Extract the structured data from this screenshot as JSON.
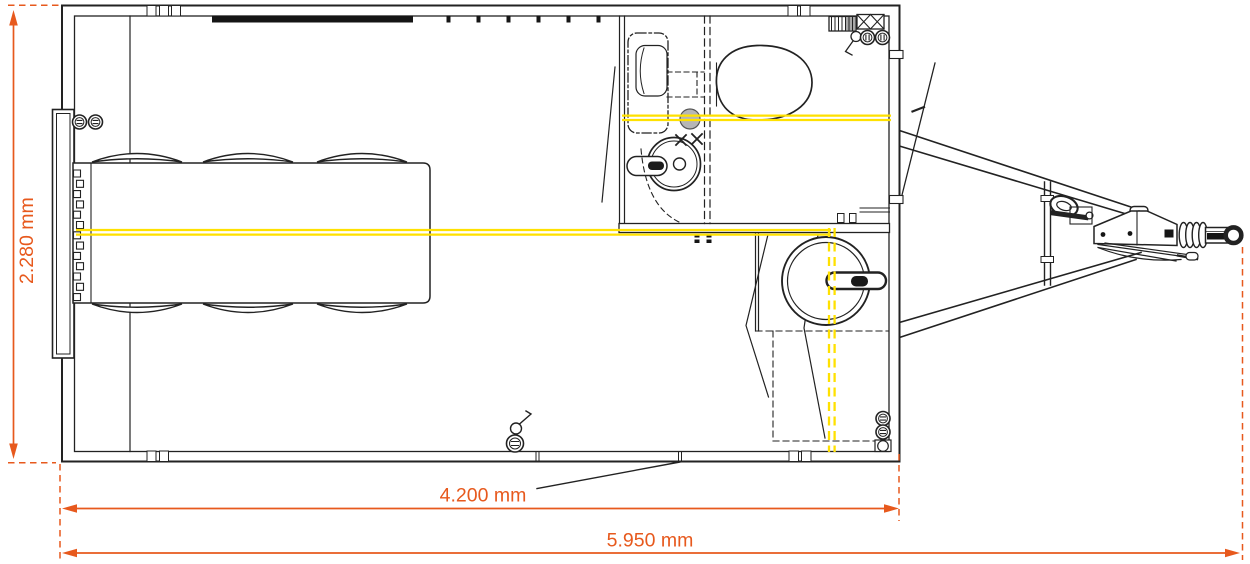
{
  "meta": {
    "title": "Trailer floor plan - technical drawing",
    "view": "top view floor plan"
  },
  "dimensions": {
    "height_label": "2.280 mm",
    "body_length_label": "4.200 mm",
    "total_length_label": "5.950 mm"
  },
  "colors": {
    "dimension_orange": "#e7591d",
    "utility_yellow": "#ffe100",
    "drawing_ink": "#222222",
    "fixture_gray": "#b6b6b6"
  },
  "components": [
    "trailer-body",
    "entrance-door",
    "conference-table",
    "chairs-x6",
    "radiator",
    "wall-sockets",
    "window-band",
    "toilet-room",
    "toilet",
    "washbasin",
    "sink-counter",
    "boiler",
    "partition-door",
    "wheel",
    "wheel-arch",
    "drawbar-frame",
    "jockey-wheel",
    "overrun-coupling",
    "handbrake-lever",
    "coupling-head",
    "axle-marking-lines"
  ]
}
